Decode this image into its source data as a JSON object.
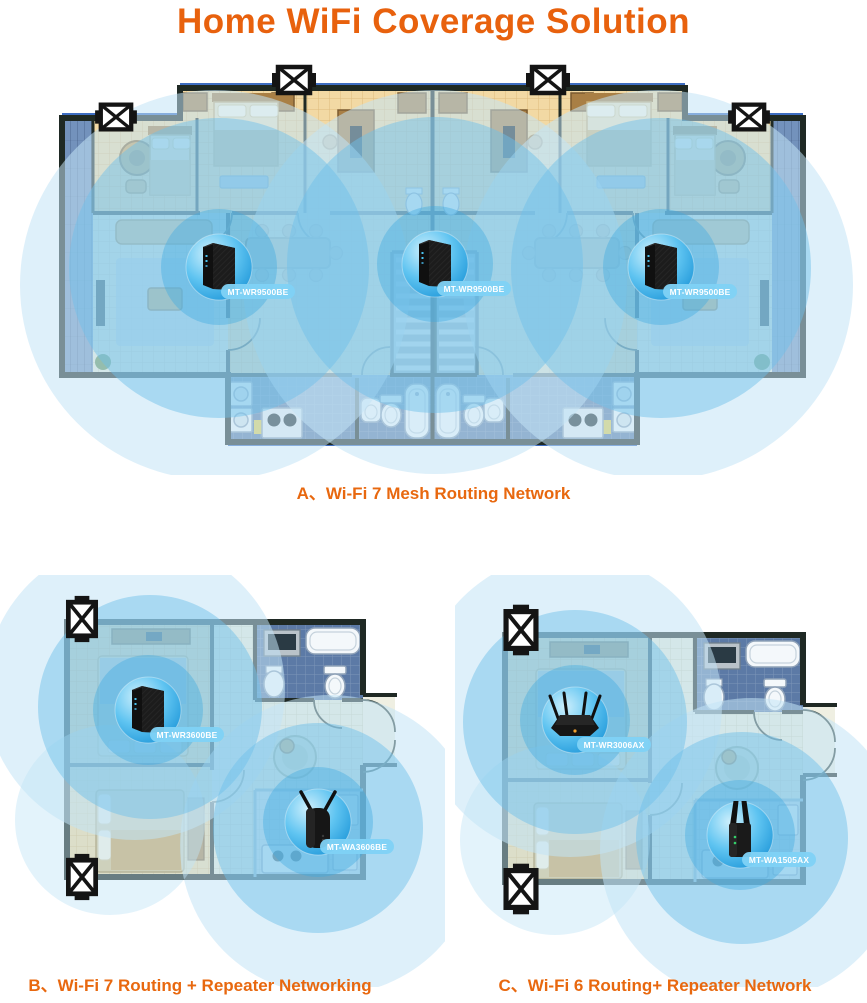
{
  "title": "Home WiFi Coverage Solution",
  "colors": {
    "accent_orange": "#E8610D",
    "coverage_inner_blue": "#6FC0EA",
    "coverage_outer_blue": "#C2E4F6",
    "device_sphere_blue": "#2FA7E2",
    "label_pill_blue": "#7FD2F6",
    "wall_dark": "#1F2924",
    "floor_tan": "#F2D9A4",
    "bathroom_blue": "#5C7AA6",
    "balcony_blue": "#7392BC"
  },
  "sections": {
    "a": {
      "caption": "A、Wi-Fi 7 Mesh Routing Network",
      "devices": [
        {
          "label": "MT-WR9500BE",
          "type": "wifi7-mesh-router"
        },
        {
          "label": "MT-WR9500BE",
          "type": "wifi7-mesh-router"
        },
        {
          "label": "MT-WR9500BE",
          "type": "wifi7-mesh-router"
        }
      ]
    },
    "b": {
      "caption": "B、Wi-Fi 7 Routing + Repeater Networking",
      "devices": [
        {
          "label": "MT-WR3600BE",
          "type": "wifi7-router"
        },
        {
          "label": "MT-WA3606BE",
          "type": "wifi7-repeater"
        }
      ]
    },
    "c": {
      "caption": "C、Wi-Fi 6 Routing+ Repeater Network",
      "devices": [
        {
          "label": "MT-WR3006AX",
          "type": "wifi6-router"
        },
        {
          "label": "MT-WA1505AX",
          "type": "wifi6-repeater"
        }
      ]
    }
  }
}
